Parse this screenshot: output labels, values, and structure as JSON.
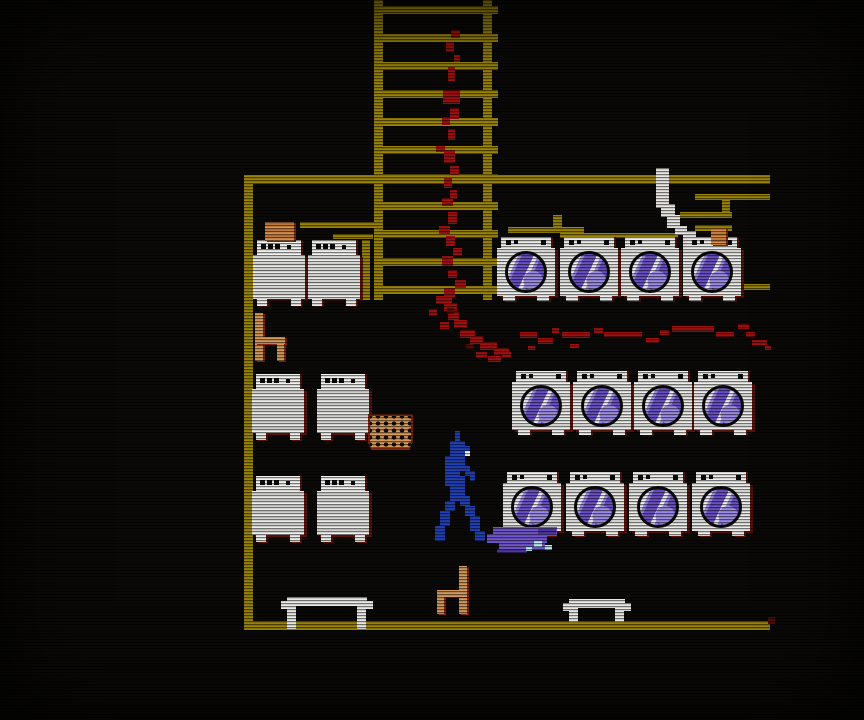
{
  "meta": {
    "scene_name": "laundromat-pixel-scene",
    "screen_w": 864,
    "screen_h": 720
  },
  "palette": {
    "gold": "#9a8306",
    "blood": "#a01010",
    "blood_dark": "#560d07",
    "machine_white": "#ececea",
    "machine_stripe": "#d0d0cc",
    "machine_shadow": "#5c120a",
    "door_purple": "#6a50c4",
    "door_purple_light": "#9d8ce4",
    "tan": "#d2985c",
    "tan_dark": "#8a2410",
    "orange": "#d98f4a",
    "char_blue": "#2240b4",
    "char_white": "#eef2f4",
    "puddle": "#7256cc",
    "puddle_dark": "#4f35a0",
    "suds": "#b5ecf0",
    "pipe_white": "#e9e6e1"
  },
  "room": {
    "left_wall": [
      244,
      175,
      9,
      455
    ],
    "ceiling": [
      244,
      175,
      526,
      9
    ],
    "floor": [
      244,
      621,
      526,
      9
    ]
  },
  "ladder": {
    "left_rail": [
      374,
      0,
      9,
      300
    ],
    "right_rail": [
      483,
      0,
      9,
      300
    ],
    "rung_x": 374,
    "rung_w": 124,
    "rung_h": 8,
    "rung_ys": [
      6,
      34,
      62,
      90,
      118,
      146,
      174,
      202,
      230,
      258,
      286
    ]
  },
  "pipes": [
    [
      300,
      222,
      75,
      6
    ],
    [
      333,
      234,
      40,
      5
    ],
    [
      362,
      240,
      8,
      60
    ],
    [
      553,
      215,
      9,
      13
    ],
    [
      508,
      227,
      76,
      6
    ],
    [
      560,
      233,
      118,
      5
    ],
    [
      630,
      238,
      9,
      22
    ],
    [
      695,
      194,
      75,
      6
    ],
    [
      722,
      200,
      8,
      18
    ],
    [
      680,
      212,
      52,
      6
    ],
    [
      695,
      225,
      37,
      6
    ],
    [
      722,
      284,
      48,
      6
    ]
  ],
  "white_pipe": [
    [
      656,
      168,
      13,
      40
    ],
    [
      661,
      204,
      14,
      13
    ],
    [
      667,
      215,
      13,
      13
    ],
    [
      675,
      226,
      12,
      9
    ],
    [
      683,
      231,
      13,
      25
    ]
  ],
  "blood": [
    [
      451,
      30,
      9,
      8
    ],
    [
      446,
      42,
      8,
      10
    ],
    [
      454,
      55,
      6,
      7
    ],
    [
      448,
      67,
      7,
      14
    ],
    [
      443,
      90,
      17,
      14
    ],
    [
      450,
      108,
      9,
      11
    ],
    [
      442,
      117,
      8,
      8
    ],
    [
      448,
      129,
      7,
      11
    ],
    [
      436,
      146,
      9,
      6
    ],
    [
      444,
      150,
      11,
      13
    ],
    [
      450,
      166,
      9,
      9
    ],
    [
      444,
      178,
      8,
      10
    ],
    [
      450,
      190,
      7,
      9
    ],
    [
      442,
      198,
      11,
      8
    ],
    [
      448,
      212,
      9,
      12
    ],
    [
      439,
      226,
      11,
      8
    ],
    [
      446,
      236,
      9,
      10
    ],
    [
      453,
      248,
      9,
      7
    ],
    [
      442,
      256,
      11,
      10
    ],
    [
      448,
      270,
      9,
      8
    ],
    [
      455,
      280,
      11,
      8
    ],
    [
      444,
      288,
      11,
      10
    ],
    [
      436,
      296,
      16,
      8
    ],
    [
      444,
      303,
      13,
      8
    ],
    [
      429,
      309,
      8,
      7
    ],
    [
      448,
      312,
      11,
      8
    ],
    [
      454,
      320,
      13,
      8
    ],
    [
      440,
      322,
      9,
      7
    ],
    [
      460,
      330,
      15,
      8
    ],
    [
      470,
      336,
      13,
      8
    ],
    [
      480,
      342,
      17,
      8
    ],
    [
      494,
      348,
      15,
      7
    ],
    [
      476,
      352,
      11,
      6
    ],
    [
      488,
      356,
      13,
      6
    ],
    [
      502,
      352,
      9,
      5
    ],
    [
      520,
      332,
      17,
      6
    ],
    [
      538,
      338,
      15,
      6
    ],
    [
      552,
      328,
      7,
      5
    ],
    [
      562,
      332,
      28,
      6
    ],
    [
      594,
      328,
      9,
      5
    ],
    [
      604,
      332,
      38,
      5
    ],
    [
      646,
      338,
      13,
      5
    ],
    [
      660,
      330,
      9,
      5
    ],
    [
      672,
      326,
      42,
      6
    ],
    [
      716,
      332,
      18,
      5
    ],
    [
      738,
      324,
      11,
      5
    ],
    [
      746,
      332,
      9,
      5
    ],
    [
      752,
      340,
      15,
      5
    ],
    [
      765,
      346,
      6,
      4
    ],
    [
      528,
      346,
      7,
      4
    ],
    [
      570,
      344,
      9,
      4
    ]
  ],
  "blood_dark": [
    [
      768,
      617,
      7,
      7
    ],
    [
      447,
      308,
      7,
      6
    ],
    [
      466,
      344,
      8,
      5
    ]
  ],
  "machines": {
    "front_size": [
      58,
      64
    ],
    "front_rows": [
      {
        "y": 237,
        "xs": [
          497,
          560,
          621,
          683
        ]
      },
      {
        "y": 371,
        "xs": [
          512,
          573,
          634,
          694
        ]
      },
      {
        "y": 472,
        "xs": [
          503,
          566,
          629,
          692
        ]
      }
    ],
    "top_size": [
      52,
      66
    ],
    "top_rows": [
      {
        "y": 240,
        "xs": [
          253,
          308
        ]
      },
      {
        "y": 374,
        "xs": [
          252,
          317
        ]
      },
      {
        "y": 476,
        "xs": [
          252,
          317
        ]
      }
    ]
  },
  "furniture": {
    "chairs": [
      {
        "x": 255,
        "y": 313,
        "h": 48,
        "flip": false
      },
      {
        "x": 437,
        "y": 566,
        "h": 48,
        "flip": true
      }
    ],
    "basket": [
      368,
      414,
      45,
      36
    ],
    "benches": [
      {
        "x": 281,
        "y": 597,
        "w": 92,
        "leg_h": 23
      },
      {
        "x": 563,
        "y": 599,
        "w": 68,
        "leg_h": 14
      }
    ],
    "boxes": [
      [
        265,
        222,
        29,
        19
      ],
      [
        711,
        228,
        15,
        17
      ]
    ]
  },
  "puddle": {
    "main": [
      [
        493,
        527,
        64,
        9
      ],
      [
        487,
        534,
        60,
        9
      ],
      [
        499,
        543,
        46,
        7
      ]
    ],
    "dark": [
      [
        538,
        529,
        18,
        5
      ],
      [
        497,
        549,
        30,
        4
      ]
    ],
    "suds": [
      [
        534,
        541,
        8,
        6
      ],
      [
        545,
        545,
        7,
        5
      ],
      [
        526,
        547,
        6,
        4
      ]
    ]
  },
  "character": {
    "x": 435,
    "y": 431,
    "cell": 5,
    "grid": [
      "....B.....",
      "....B.....",
      "...BBB....",
      "...BBBB...",
      "...BBBW...",
      "..BBBB....",
      "..BBBB....",
      "..BBBBB...",
      "..BBB.BB..",
      "..BBBB.B..",
      "..BBBB....",
      "...BBB....",
      "...BBB....",
      "...BBBB...",
      "..BB.BB...",
      "..BB..BB..",
      ".BB...BB..",
      ".BB....BB.",
      ".BB....BB.",
      "BB.....BB.",
      "BB......BB",
      "BB......BB"
    ]
  }
}
